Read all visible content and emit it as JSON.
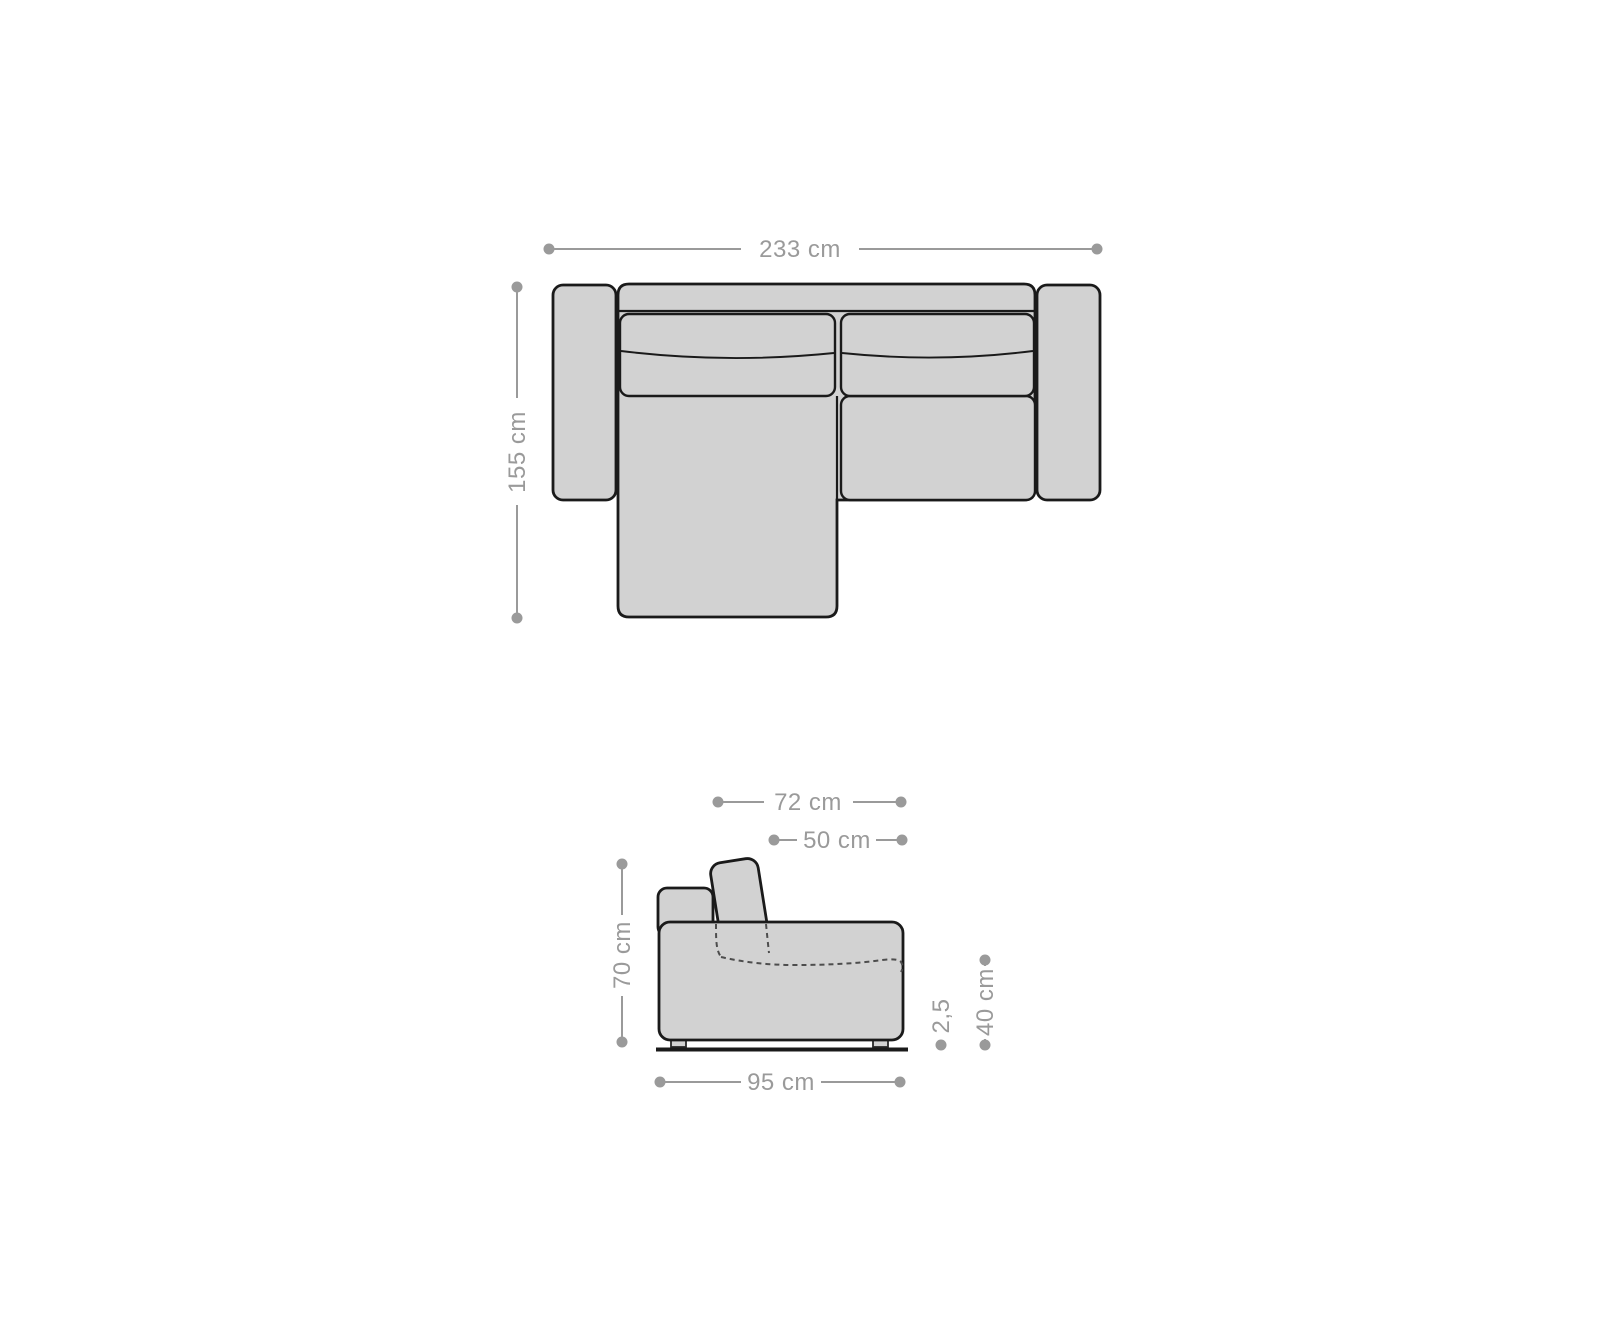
{
  "page": {
    "background": "#ffffff"
  },
  "colors": {
    "sofa_fill": "#d2d2d2",
    "sofa_outline": "#1a1a1a",
    "dimension_gray": "#9a9a9a",
    "hidden_edge_gray": "#4d4d4d"
  },
  "top_view": {
    "width_label": "233 cm",
    "depth_label": "155 cm"
  },
  "side_view": {
    "upper_depth_label": "72 cm",
    "seat_depth_label": "50 cm",
    "height_label": "70 cm",
    "base_depth_label": "95 cm",
    "leg_height_label": "2,5",
    "seat_height_label": "40 cm"
  }
}
